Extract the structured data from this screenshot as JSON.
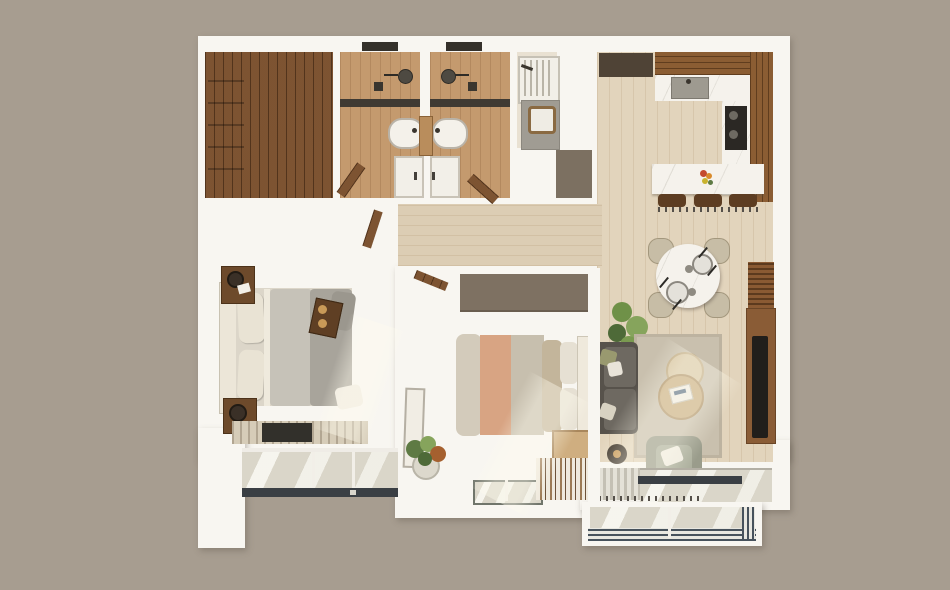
{
  "scene": {
    "type": "3d-apartment-floor-plan-top-down-render",
    "visible_text": "none",
    "background_color": "#a79d90",
    "wall_color": "#f8f6f1"
  },
  "palette": {
    "bedroom_floor": "#c9a170",
    "pale_floor": "#e2d4bc",
    "bathroom_floor": "#c49a6e",
    "dark_wardrobe_wood": "#6e4526",
    "kitchen_cabinet_wood": "#7b4e27",
    "marble_counter": "#f5f2ec",
    "shower_tile": "#b1aca3",
    "taupe_block": "#7c7061",
    "terracotta_tile": "#bd7e5e",
    "glass": "#dad6c9",
    "window_frame": "#3a3f44",
    "sofa": "#57524b",
    "area_rug": "#c9c0ae",
    "bed1_duvet": "#a8a49b",
    "bed2_blanket_peach": "#d8a483",
    "plant_green": "#5e7a44"
  },
  "rooms": [
    {
      "id": "walk-in-closet",
      "label": "Walk-in closet",
      "furniture": [
        "u-shaped-wardrobe"
      ]
    },
    {
      "id": "bathroom-1",
      "label": "Bathroom 1",
      "furniture": [
        "shower",
        "oval-basin",
        "shower-tray",
        "door"
      ]
    },
    {
      "id": "bathroom-2",
      "label": "Bathroom 2",
      "furniture": [
        "shower",
        "oval-basin",
        "shower-tray",
        "door"
      ]
    },
    {
      "id": "laundry",
      "label": "Laundry room",
      "furniture": [
        "washer",
        "laundry-unit",
        "basket"
      ]
    },
    {
      "id": "entry",
      "label": "Entry",
      "furniture": [
        "door-mat"
      ]
    },
    {
      "id": "kitchen",
      "label": "Kitchen",
      "furniture": [
        "fridge",
        "u-counter",
        "sink",
        "cooktop",
        "island",
        "bar-stool",
        "bar-stool",
        "bar-stool",
        "flower-vase"
      ]
    },
    {
      "id": "hallway",
      "label": "Hallway",
      "furniture": [
        "open-door-leaf",
        "open-door-leaf"
      ]
    },
    {
      "id": "bedroom-1",
      "label": "Master bedroom",
      "furniture": [
        "double-bed",
        "headboard",
        "nightstand",
        "nightstand",
        "table-lamp",
        "striped-rug",
        "breakfast-tray"
      ]
    },
    {
      "id": "bedroom-2",
      "label": "Bedroom 2",
      "furniture": [
        "double-bed",
        "wardrobe",
        "nightstand",
        "leaning-mirror",
        "potted-plant",
        "striped-rug",
        "pouf"
      ]
    },
    {
      "id": "living-dining",
      "label": "Living / dining room",
      "furniture": [
        "round-dining-table",
        "dining-chair",
        "dining-chair",
        "dining-chair",
        "dining-chair",
        "plates",
        "sofa",
        "area-rug",
        "coffee-table",
        "coffee-table",
        "armchair",
        "side-table-lamp",
        "tv-console",
        "tv",
        "slat-panel",
        "plant"
      ]
    },
    {
      "id": "window-bay",
      "label": "Bedroom window bay",
      "furniture": [
        "sliding-window"
      ]
    },
    {
      "id": "balcony",
      "label": "Balcony",
      "furniture": [
        "glass-railing"
      ]
    }
  ]
}
